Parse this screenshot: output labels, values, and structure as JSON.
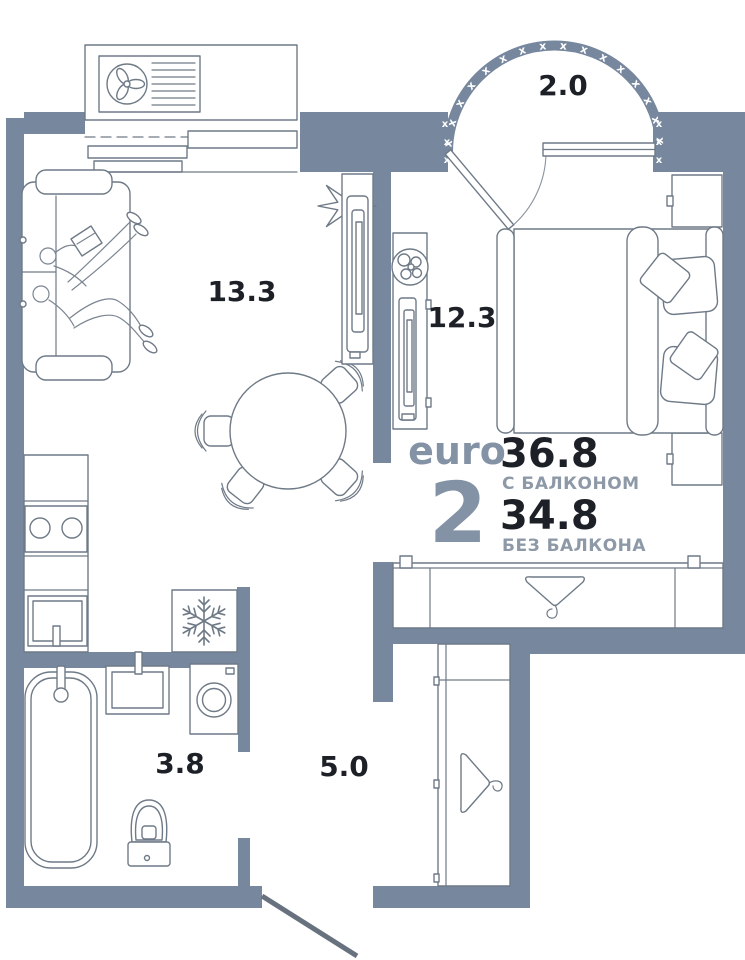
{
  "plan": {
    "brand": "euro",
    "rooms_count": "2",
    "area_with_balcony": "36.8",
    "with_balcony_label": "С БАЛКОНОМ",
    "area_without_balcony": "34.8",
    "without_balcony_label": "БЕЗ БАЛКОНА",
    "room_labels": {
      "living": "13.3",
      "bedroom": "12.3",
      "balcony": "2.0",
      "bathroom": "3.8",
      "hallway": "5.0"
    },
    "balcony_hatch": "x x x x x x x x x x x x x x x x x x x x",
    "hatch_char": "x",
    "colors": {
      "wall": "#76879e",
      "furniture_line": "#6f7a87",
      "label_text": "#1d2127",
      "accent_text": "#8492a6",
      "muted_text": "#8e99a8"
    },
    "icons": {
      "fan-icon": "3-blade-fan",
      "snowflake-icon": "6-spoke-snowflake",
      "hanger-icon": "clothes-hanger",
      "plant-icon": "potted-plant"
    }
  }
}
